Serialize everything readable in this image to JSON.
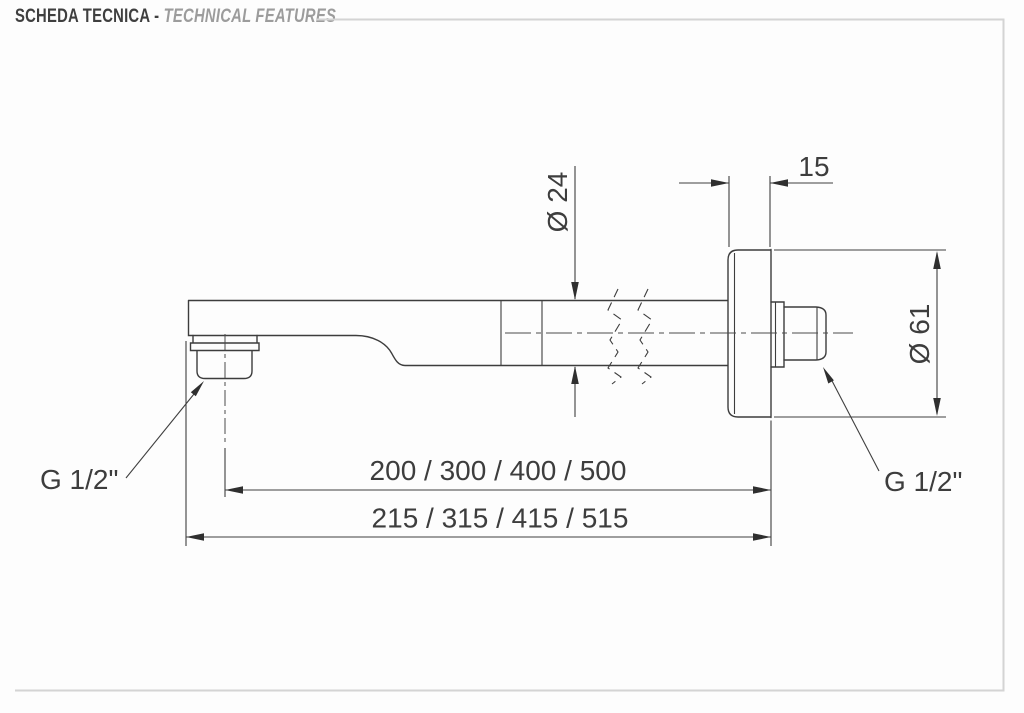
{
  "header": {
    "title_primary": "SCHEDA TECNICA -",
    "title_secondary": "TECHNICAL FEATURES"
  },
  "dimensions": {
    "flange_thickness": "15",
    "arm_diameter": "Ø 24",
    "flange_diameter": "Ø 61",
    "length_to_spout_center": "200 / 300 / 400 / 500",
    "length_overall": "215 / 315 / 415 / 515",
    "outlet_thread": "G 1/2\"",
    "inlet_thread": "G 1/2\""
  },
  "colors": {
    "line": "#3d3d3d",
    "dimension_text": "#3d3d3d",
    "frame": "#d4d4d4",
    "title_primary": "#3f3f3f",
    "title_secondary": "#9c9c9c",
    "background": "#fdfdfd"
  }
}
